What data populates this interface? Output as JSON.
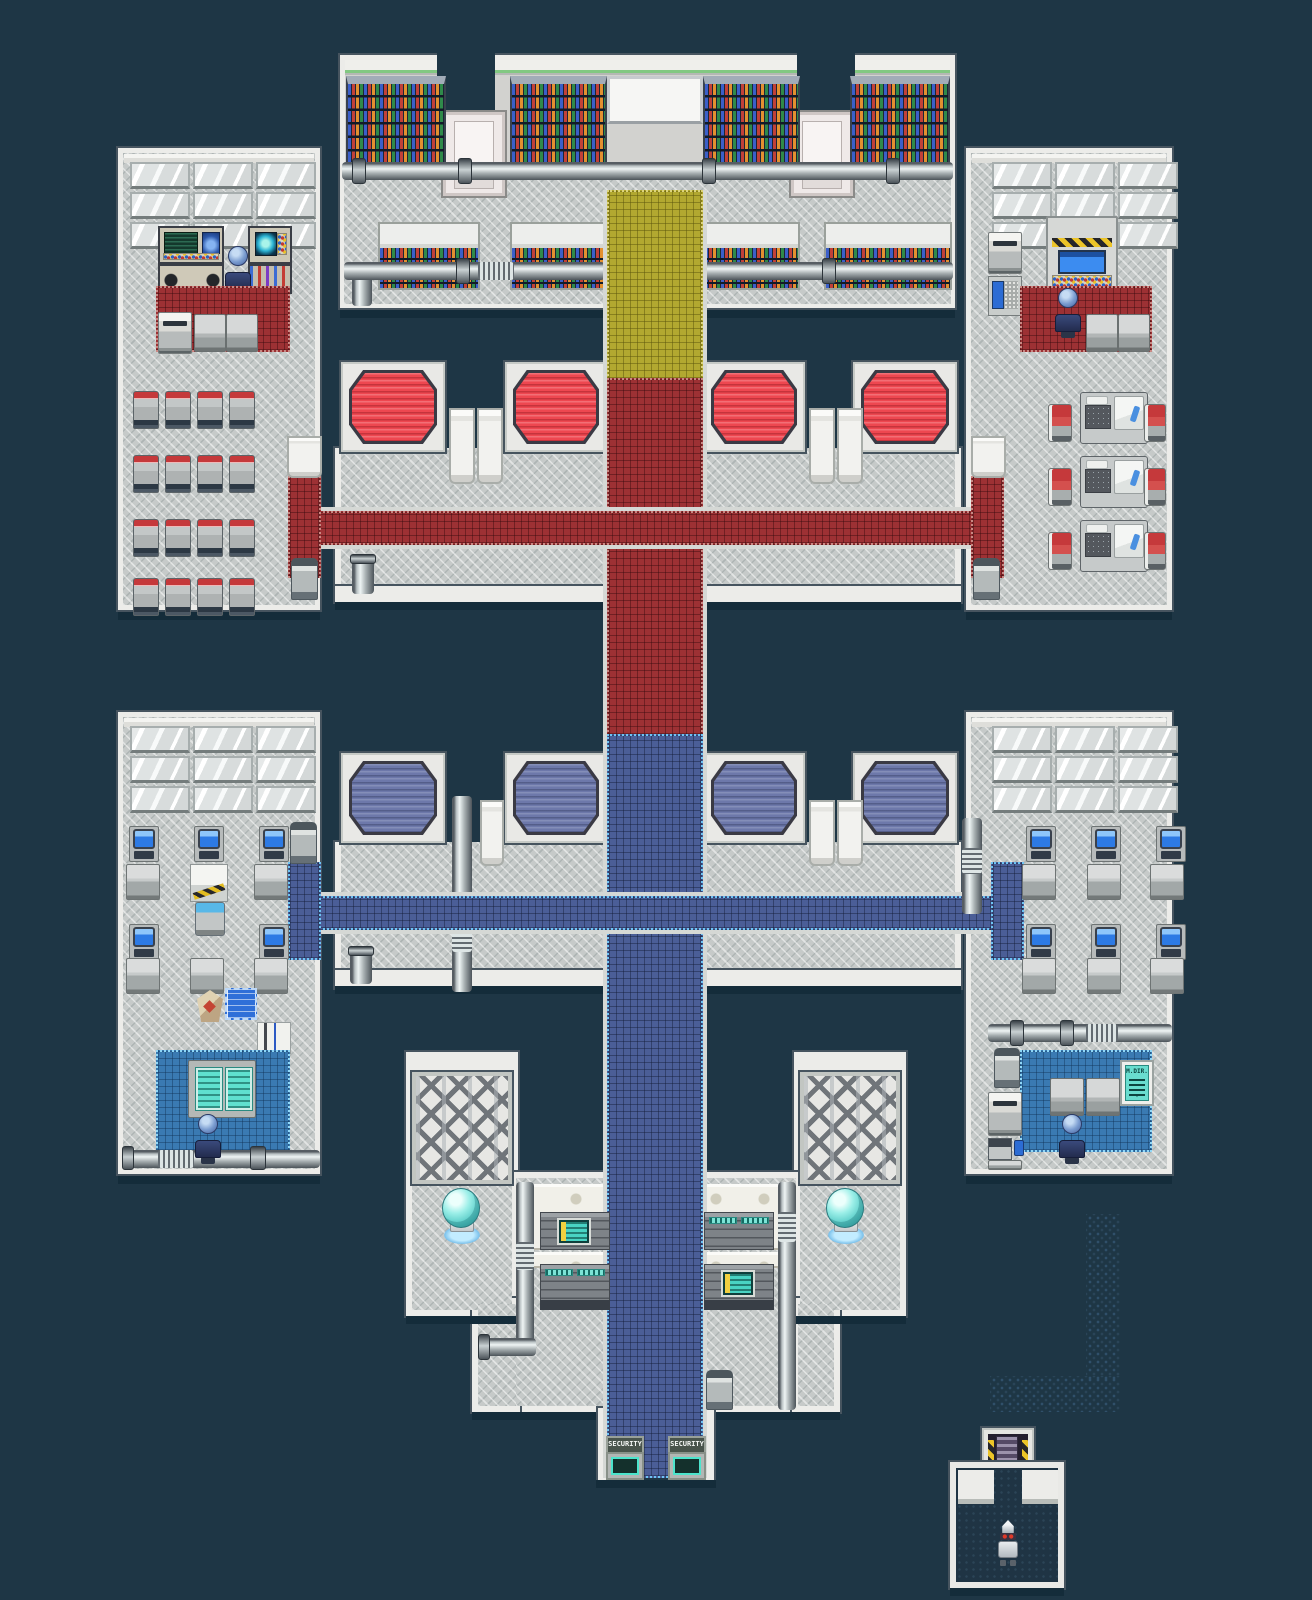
{
  "scene": {
    "type": "game-map",
    "description": "Top-down pixel-art sci-fi facility interior: library hall, office rooms, sleeping quarters, workshop, laboratory and a security gate",
    "background_color": "#1e3645"
  },
  "labels": {
    "security_gate_left": "SECURITY",
    "security_gate_right": "SECURITY",
    "directory_sign_title": "M.DIR.",
    "directory_sign_arrow": "▼"
  },
  "palette": {
    "background": "#1e3645",
    "floor_gray": "#c6cac9",
    "wall_white": "#ecece9",
    "carpet_red": "#9d3134",
    "carpet_blue": "#4b5e97",
    "carpet_yellow": "#b2a830",
    "room_mat_blue": "#3a7ab2",
    "table_top_red": "#ee4750",
    "table_top_blue": "#6d78aa",
    "monitor_screen_blue": "#2d7ae4",
    "terminal_teal": "#49d3c3",
    "hazard_yellow": "#ecc428",
    "glass_dome_cyan": "#9cefe8"
  },
  "map": {
    "library": {
      "tall_bookshelves": 4,
      "low_bookshelves": 4,
      "whiteboard": 1,
      "pipes": 2,
      "doors": 2
    },
    "upper_left_room": {
      "window_panes": 9,
      "consoles": 4,
      "waiting_seats": 16,
      "copier": 1,
      "tables": 2,
      "seated_characters": 1
    },
    "upper_right_room": {
      "window_panes": 9,
      "hazard_machine": 1,
      "sleep_pods": 3,
      "red_chairs": 6,
      "tables": 2,
      "copiers": 2,
      "seated_characters": 1
    },
    "upper_hall": {
      "red_tables": 4,
      "door_panels": 4,
      "trash_bins": 2
    },
    "lower_hall": {
      "blue_tables": 4,
      "door_panels": 3,
      "vertical_pipe": 1,
      "trash_bins": 1
    },
    "lower_left_room": {
      "window_panes": 9,
      "computer_workstations": 5,
      "desks": 6,
      "blueprint": 1,
      "map_sheet": 1,
      "tool_board": 1,
      "teal_machine": 1,
      "seated_characters": 1
    },
    "lower_right_room": {
      "window_panes": 9,
      "computer_workstations": 6,
      "desks": 6,
      "directory_sign": 1,
      "tables": 2,
      "copier": 1,
      "printer": 1,
      "seated_characters": 1
    },
    "laboratory": {
      "lattice_walls": 2,
      "glass_domes": 2,
      "server_racks": 4,
      "keyhole_walls": 4,
      "security_doors": 2
    },
    "elevator_room": {
      "elevator": 1,
      "robot_characters": 1
    },
    "corridors": {
      "yellow_carpet": 1,
      "red_cross_corridor": 1,
      "blue_cross_corridor": 1,
      "hidden_dim_path": 1
    }
  },
  "characters": [
    {
      "name": "seated-figure-upper-left",
      "color": "blue"
    },
    {
      "name": "seated-figure-upper-right",
      "color": "blue"
    },
    {
      "name": "seated-figure-lower-left",
      "color": "blue"
    },
    {
      "name": "seated-figure-lower-right",
      "color": "blue"
    },
    {
      "name": "robot",
      "color": "silver"
    }
  ]
}
